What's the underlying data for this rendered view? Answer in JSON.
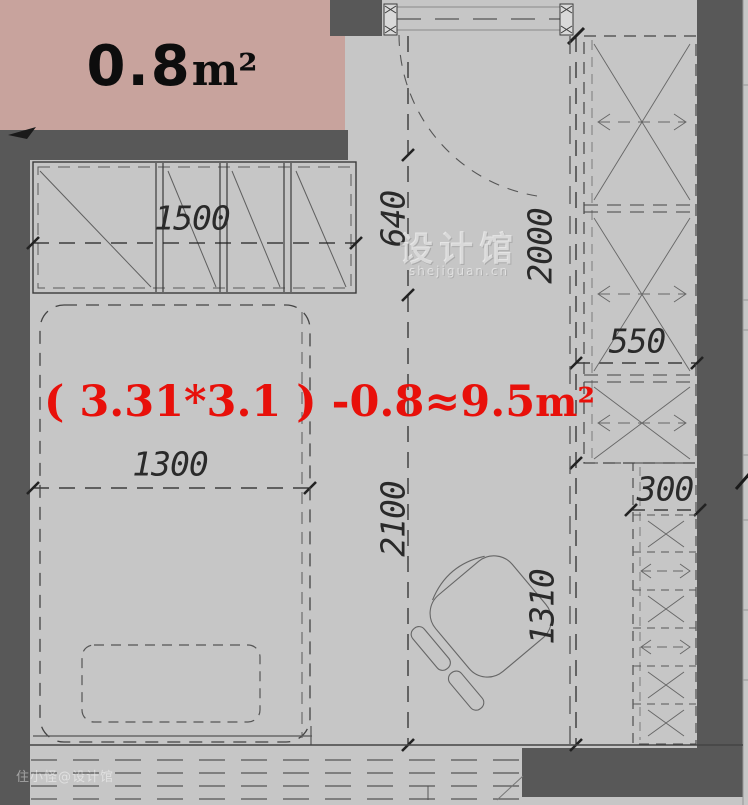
{
  "plan": {
    "balcony": {
      "area": "0.8",
      "unit": "m²"
    },
    "formula": {
      "text": "( 3.31*3.1 ) -0.8≈9.5",
      "unit": "m²"
    },
    "dimensions": {
      "closet_width": "1500",
      "entry_depth": "640",
      "wardrobe_run": "2000",
      "bed_width": "1300",
      "room_length": "2100",
      "cabinet_width": "550",
      "shelf_width": "300",
      "lower_run": "1310"
    },
    "watermarks": {
      "center_title": "设计馆",
      "center_subtitle": "shejiguan.cn",
      "corner": "住小怪@设计馆"
    },
    "colors": {
      "background": "#c6c6c6",
      "wall": "#585858",
      "balcony_fill": "#c8a39d",
      "line": "#3a3a3a",
      "accent_red": "#e8100a"
    }
  }
}
